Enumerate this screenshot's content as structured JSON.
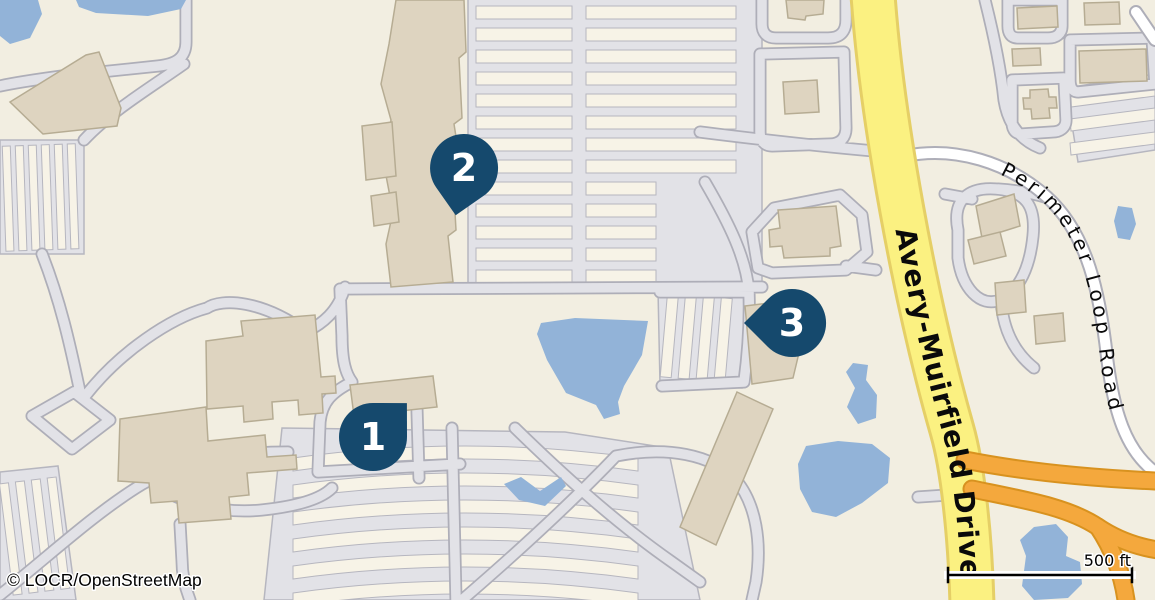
{
  "map": {
    "attribution": "© LOCR/OpenStreetMap",
    "scale_label": "500 ft",
    "roads": {
      "avery_muirfield": "Avery-Muirfield Drive",
      "perimeter_loop": "Perimeter Loop Road"
    },
    "markers": [
      {
        "number": "1"
      },
      {
        "number": "2"
      },
      {
        "number": "3"
      }
    ]
  },
  "colors": {
    "bg": "#f2eee1",
    "lot": "#e2e2e7",
    "lot-stroke": "#b6b6bf",
    "island": "#f7f3e7",
    "building": "#ded4c0",
    "building-stroke": "#b6ac93",
    "water": "#92b3d8",
    "road-casing": "#aeaeb8",
    "road-white": "#ffffff",
    "road-yellow": "#fbf181",
    "road-yellow-casing": "#e5cf66",
    "road-orange": "#f4a83d",
    "road-orange-casing": "#d8921f",
    "marker": "#15496d",
    "marker-text": "#ffffff",
    "label": "#0a0a0a"
  }
}
